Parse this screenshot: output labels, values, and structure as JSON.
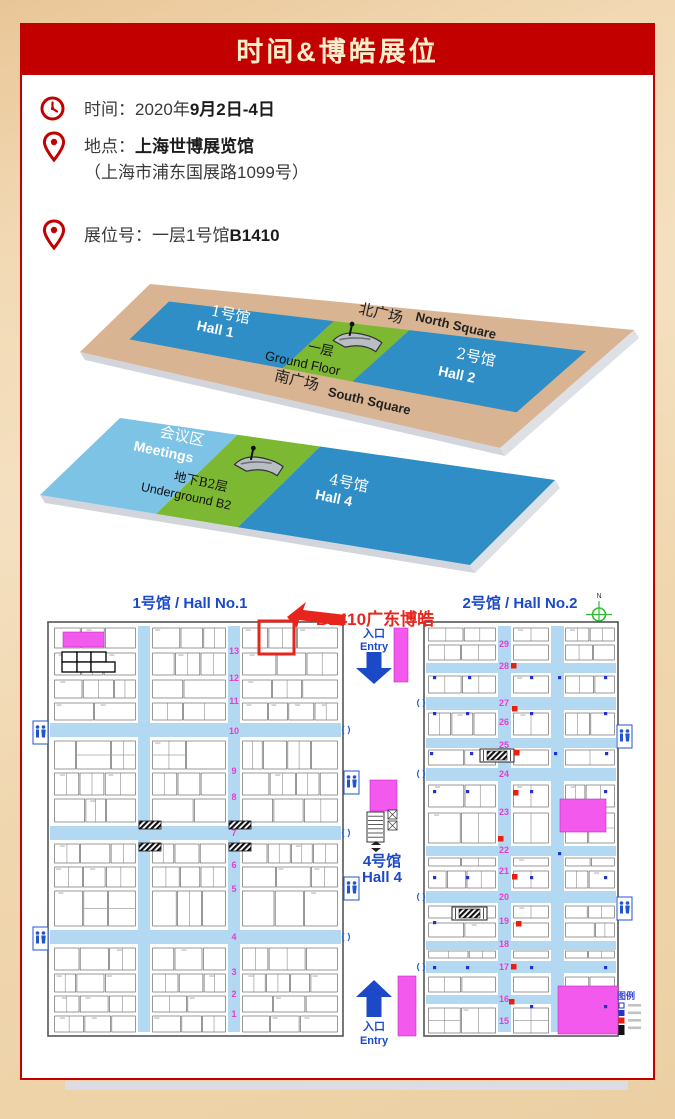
{
  "banner": {
    "title": "时间&博皓展位",
    "bg": "#c30000",
    "text_color": "#f8eecb"
  },
  "info": {
    "time": {
      "label": "时间：",
      "prefix": "2020年",
      "bold": "9月2日-4日"
    },
    "location": {
      "label": "地点：",
      "bold": "上海世博展览馆",
      "address": "（上海市浦东国展路1099号）"
    },
    "booth": {
      "label": "展位号：",
      "prefix": "一层1号馆",
      "bold": "B1410"
    }
  },
  "venue3d": {
    "upper": {
      "north_cn": "北广场",
      "north_en": "North Square",
      "south_cn": "南广场",
      "south_en": "South Square",
      "hall1_cn": "1号馆",
      "hall1_en": "Hall 1",
      "hall2_cn": "2号馆",
      "hall2_en": "Hall 2",
      "floor_cn": "一层",
      "floor_en": "Ground Floor"
    },
    "lower": {
      "meetings_cn": "会议区",
      "meetings_en": "Meetings",
      "hall4_cn": "4号馆",
      "hall4_en": "Hall 4",
      "floor_cn": "地下B2层",
      "floor_en": "Underground B2"
    },
    "colors": {
      "hall": "#2e8ec5",
      "meetings": "#7cc3e6",
      "green": "#7db832",
      "plaza": "#d8b493",
      "side": "#d2d6dc"
    }
  },
  "floorplan": {
    "hall1_title": "1号馆 / Hall No.1",
    "hall2_title": "2号馆 / Hall No.2",
    "annotation": "B1410广东博皓",
    "compass": "N",
    "entry": {
      "cn": "入口",
      "en": "Entry"
    },
    "hall4": {
      "cn": "4号馆",
      "en": "Hall 4"
    },
    "legend_title": "图例",
    "hall1_aisles": [
      "13",
      "12",
      "11",
      "10",
      "9",
      "8",
      "7",
      "6",
      "5",
      "4",
      "3",
      "2",
      "1"
    ],
    "hall2_aisles": [
      "29",
      "28",
      "27",
      "26",
      "25",
      "24",
      "23",
      "22",
      "21",
      "20",
      "19",
      "18",
      "17",
      "16",
      "15"
    ],
    "colors": {
      "aisle": "#b3d9f2",
      "number": "#e83bd0",
      "title_blue": "#1b49c8",
      "magenta": "#f459ee",
      "highlight_red": "#e8251d",
      "marker_red": "#e82010",
      "pillar_blue": "#2233cc",
      "compass_green": "#33bb33"
    }
  }
}
